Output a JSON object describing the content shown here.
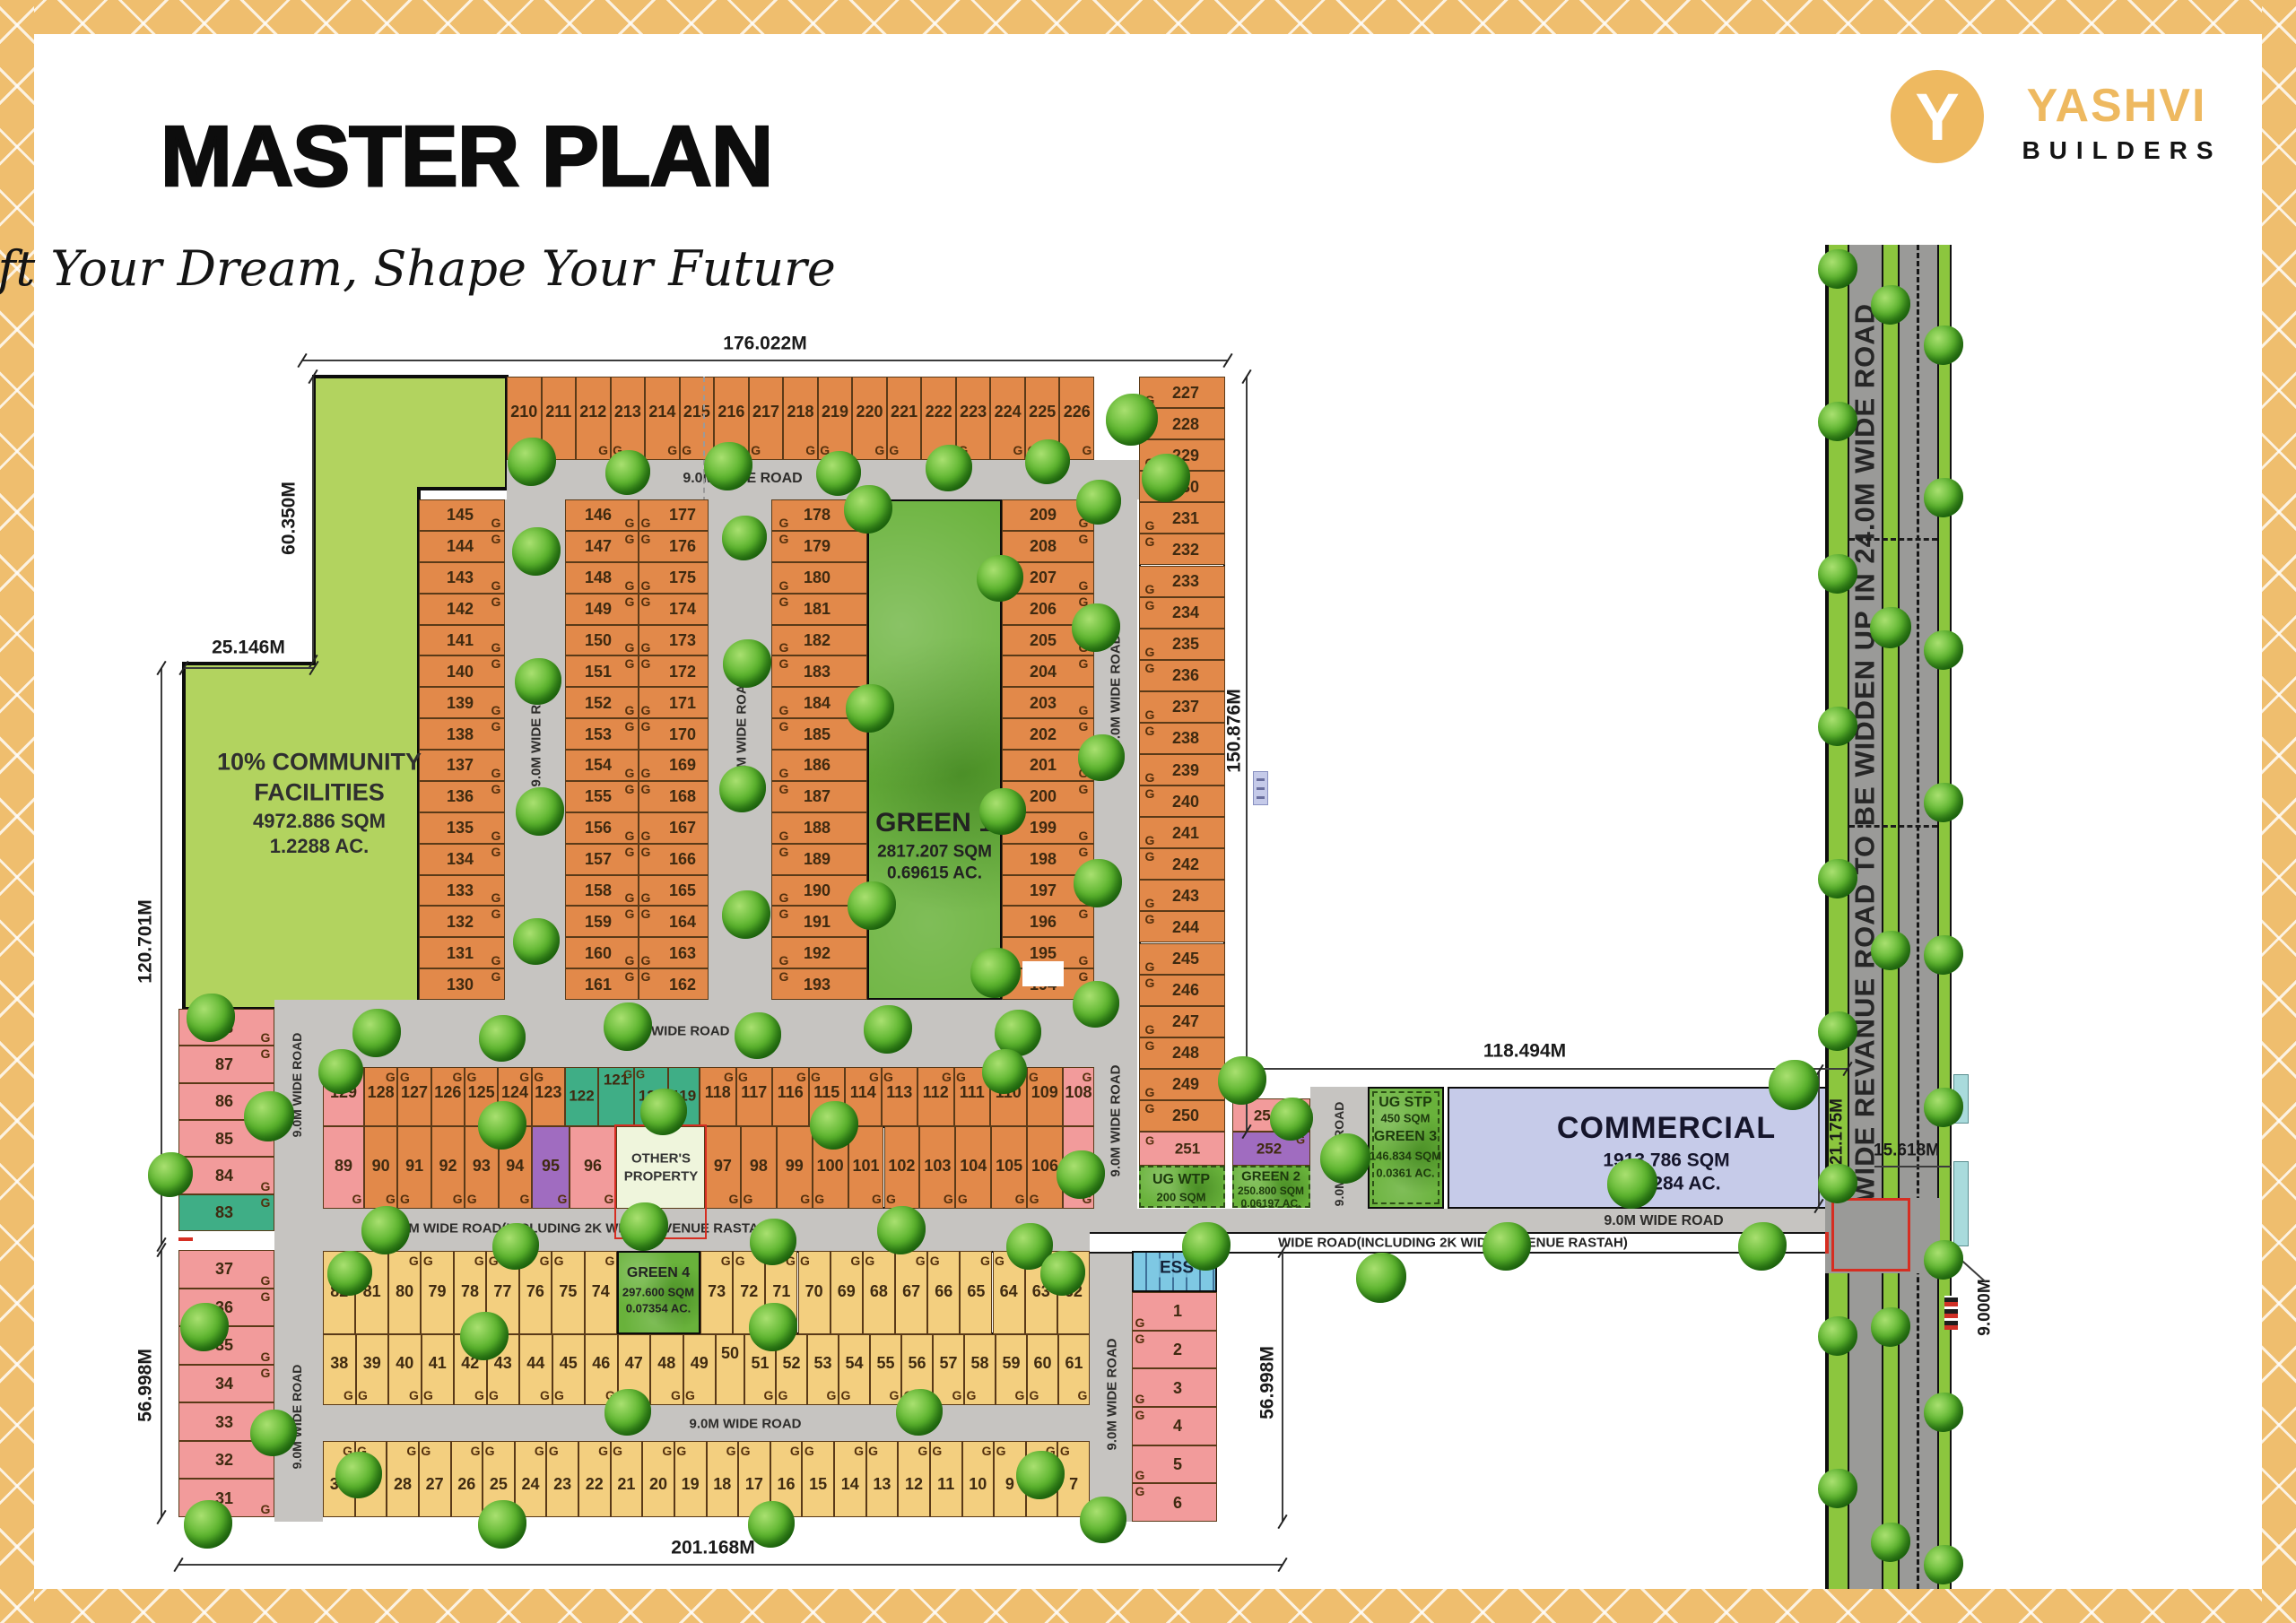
{
  "header": {
    "title": "MASTER PLAN",
    "subtitle": "Craft Your Dream, Shape Your Future"
  },
  "logo": {
    "brand": "YASHVI",
    "brand_sub": "BUILDERS",
    "glyph": "Y"
  },
  "labels": {
    "garage": "G"
  },
  "palette": {
    "plot_orange": "#e2894a",
    "plot_pink": "#f29b9b",
    "plot_teal": "#3fae86",
    "plot_purple": "#a06cc0",
    "plot_yellow": "#f3cf7f",
    "community_green": "#b2d35f",
    "green_area": "#69b23b",
    "commercial": "#c6cbe9",
    "ess_blue": "#7ec8e3",
    "road_gray": "#c6c4c1",
    "highway_gray": "#9a9a98",
    "road_green": "#8cc63e",
    "frame_gold": "#efbe6e",
    "red_outline": "#d62e22"
  },
  "roads": {
    "top": "9.0M WIDE ROAD",
    "mid": "9.0M WIDE ROAD",
    "vertical": "9.0M WIDE ROAD",
    "yellow_mid": "9.0M WIDE ROAD",
    "commercial": "9.0M WIDE ROAD",
    "revenue_left": "9.0M WIDE ROAD(INCLUDING 2K WIDE REVENUE RASTAH)",
    "revenue_right": "WIDE ROAD(INCLUDING 2K WIDE REVENUE RASTAH)",
    "highway": "5K WIDE REVANUE ROAD TO BE WIDDEN UP IN 24.0M WIDE ROAD"
  },
  "areas": {
    "community": {
      "line1": "10% COMMUNITY",
      "line2": "FACILITIES",
      "area": "4972.886 SQM",
      "acres": "1.2288 AC."
    },
    "green1": {
      "name": "GREEN 1",
      "area": "2817.207 SQM",
      "acres": "0.69615 AC."
    },
    "green2": {
      "name": "GREEN 2",
      "area": "250.800 SQM",
      "acres": "0.06197 AC."
    },
    "green3": {
      "name": "GREEN 3",
      "area": "146.834 SQM",
      "acres": "0.0361 AC."
    },
    "green4": {
      "name": "GREEN 4",
      "area": "297.600 SQM",
      "acres": "0.07354 AC."
    },
    "ugstp": {
      "name": "UG STP",
      "area": "450 SQM"
    },
    "ugwtp": {
      "name": "UG WTP",
      "area": "200 SQM"
    },
    "commercial": {
      "name": "COMMERCIAL",
      "area": "1913.786 SQM",
      "acres": "0.47284 AC."
    },
    "others": {
      "line1": "OTHER'S",
      "line2": "PROPERTY"
    },
    "ess": {
      "name": "ESS"
    }
  },
  "dimensions": {
    "top": "176.022M",
    "left_top": "60.350M",
    "left_step": "25.146M",
    "left_mid": "120.701M",
    "left_bottom": "56.998M",
    "right_col": "150.876M",
    "commercial_top": "118.494M",
    "bottom": "201.168M",
    "right_bottom_col": "56.998M",
    "commercial_depth": "21.175M",
    "junction": "15.618M",
    "road_width": "9.000M"
  },
  "plots": {
    "top_row": [
      "210",
      "211",
      "212",
      "213",
      "214",
      "215",
      "216",
      "217",
      "218",
      "219",
      "220",
      "221",
      "222",
      "223",
      "224",
      "225",
      "226"
    ],
    "right_col": [
      "227",
      "228",
      "229",
      "230",
      "231",
      "232",
      "233",
      "234",
      "235",
      "236",
      "237",
      "238",
      "239",
      "240",
      "241",
      "242",
      "243",
      "244",
      "245",
      "246",
      "247",
      "248",
      "249",
      "250"
    ],
    "colA": [
      "145",
      "144",
      "143",
      "142",
      "141",
      "140",
      "139",
      "138",
      "137",
      "136",
      "135",
      "134",
      "133",
      "132",
      "131",
      "130"
    ],
    "blockB_left": [
      "146",
      "147",
      "148",
      "149",
      "150",
      "151",
      "152",
      "153",
      "154",
      "155",
      "156",
      "157",
      "158",
      "159",
      "160",
      "161"
    ],
    "blockB_right": [
      "177",
      "176",
      "175",
      "174",
      "173",
      "172",
      "171",
      "170",
      "169",
      "168",
      "167",
      "166",
      "165",
      "164",
      "163",
      "162"
    ],
    "blockC": [
      "178",
      "179",
      "180",
      "181",
      "182",
      "183",
      "184",
      "185",
      "186",
      "187",
      "188",
      "189",
      "190",
      "191",
      "192",
      "193"
    ],
    "colD": [
      "209",
      "208",
      "207",
      "206",
      "205",
      "204",
      "203",
      "202",
      "201",
      "200",
      "199",
      "198",
      "197",
      "196",
      "195",
      "194"
    ],
    "rowF_top_1": [
      "129"
    ],
    "rowF_top_2": [
      "128",
      "127",
      "126",
      "125",
      "124",
      "123"
    ],
    "teal_group": [
      "122",
      "121",
      "120",
      "119"
    ],
    "rowF_top_3": [
      "118",
      "117",
      "116",
      "115",
      "114",
      "113",
      "112",
      "111",
      "110",
      "109"
    ],
    "rowF_top_4": [
      "108"
    ],
    "rowF_bot_1": [
      "89"
    ],
    "rowF_bot_2": [
      "90",
      "91",
      "92",
      "93",
      "94"
    ],
    "rowF_bot_3": [
      "95"
    ],
    "rowF_bot_4": [
      "96"
    ],
    "rowF_bot_5": [
      "97",
      "98",
      "99",
      "100",
      "101",
      "102",
      "103",
      "104",
      "105",
      "106"
    ],
    "rowF_bot_6": [
      "107"
    ],
    "yellow1_left": [
      "82",
      "81",
      "80",
      "79",
      "78",
      "77",
      "76",
      "75",
      "74"
    ],
    "yellow1_right": [
      "73",
      "72",
      "71",
      "70",
      "69",
      "68",
      "67",
      "66",
      "65",
      "64",
      "63",
      "62"
    ],
    "yellow2_left": [
      "38",
      "39",
      "40",
      "41",
      "42",
      "43",
      "44",
      "45",
      "46",
      "47",
      "48",
      "49"
    ],
    "yellow2_mid": [
      "50"
    ],
    "yellow2_right": [
      "51",
      "52",
      "53",
      "54",
      "55",
      "56",
      "57",
      "58",
      "59",
      "60",
      "61"
    ],
    "yellow3": [
      "30",
      "29",
      "28",
      "27",
      "26",
      "25",
      "24",
      "23",
      "22",
      "21",
      "20",
      "19",
      "18",
      "17",
      "16",
      "15",
      "14",
      "13",
      "12",
      "11",
      "10",
      "9",
      "8",
      "7"
    ],
    "left_col_upper": [
      "88",
      "87",
      "86",
      "85",
      "84",
      "83"
    ],
    "left_col_lower": [
      "37",
      "36",
      "35",
      "34",
      "33",
      "32",
      "31"
    ],
    "right_units": [
      "1",
      "2",
      "3",
      "4",
      "5",
      "6"
    ],
    "p251": "251",
    "p252": "252",
    "p253": "253"
  }
}
